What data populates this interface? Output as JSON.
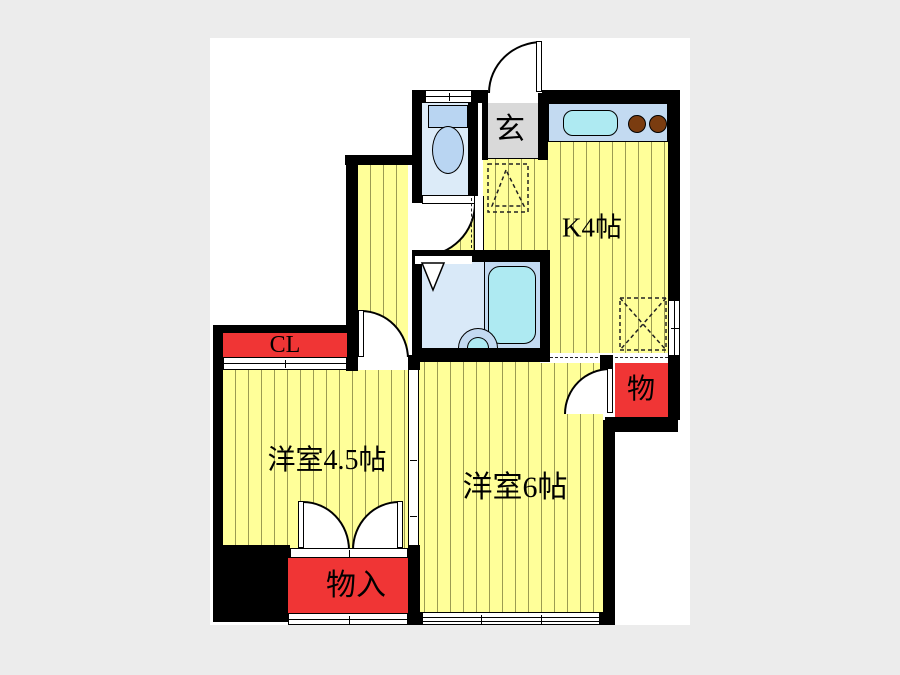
{
  "page": {
    "background_color": "#ececec",
    "plan_background_color": "#ffffff"
  },
  "colors": {
    "wall": "#000000",
    "floor_yellow": "#ffff99",
    "floor_stripe": "#9b9b52",
    "storage_red": "#f03535",
    "entrance_gray": "#d9d9d9",
    "toilet_floor_blue": "#dcebf8",
    "fixture_blue": "#b9d5f2",
    "bath_floor_blue": "#d9e9f8",
    "bath_unit_blue": "#c3daf1",
    "water_cyan": "#aeeaf2",
    "burner_brown": "#7a3c10"
  },
  "rooms": {
    "kitchen": {
      "label": "K4帖"
    },
    "entrance": {
      "label": "玄"
    },
    "closet": {
      "label": "CL"
    },
    "western_room_4_5": {
      "label": "洋室4.5帖"
    },
    "western_room_6": {
      "label": "洋室6帖"
    },
    "storage_right": {
      "label": "物"
    },
    "storage_bottom": {
      "label": "物入"
    }
  }
}
